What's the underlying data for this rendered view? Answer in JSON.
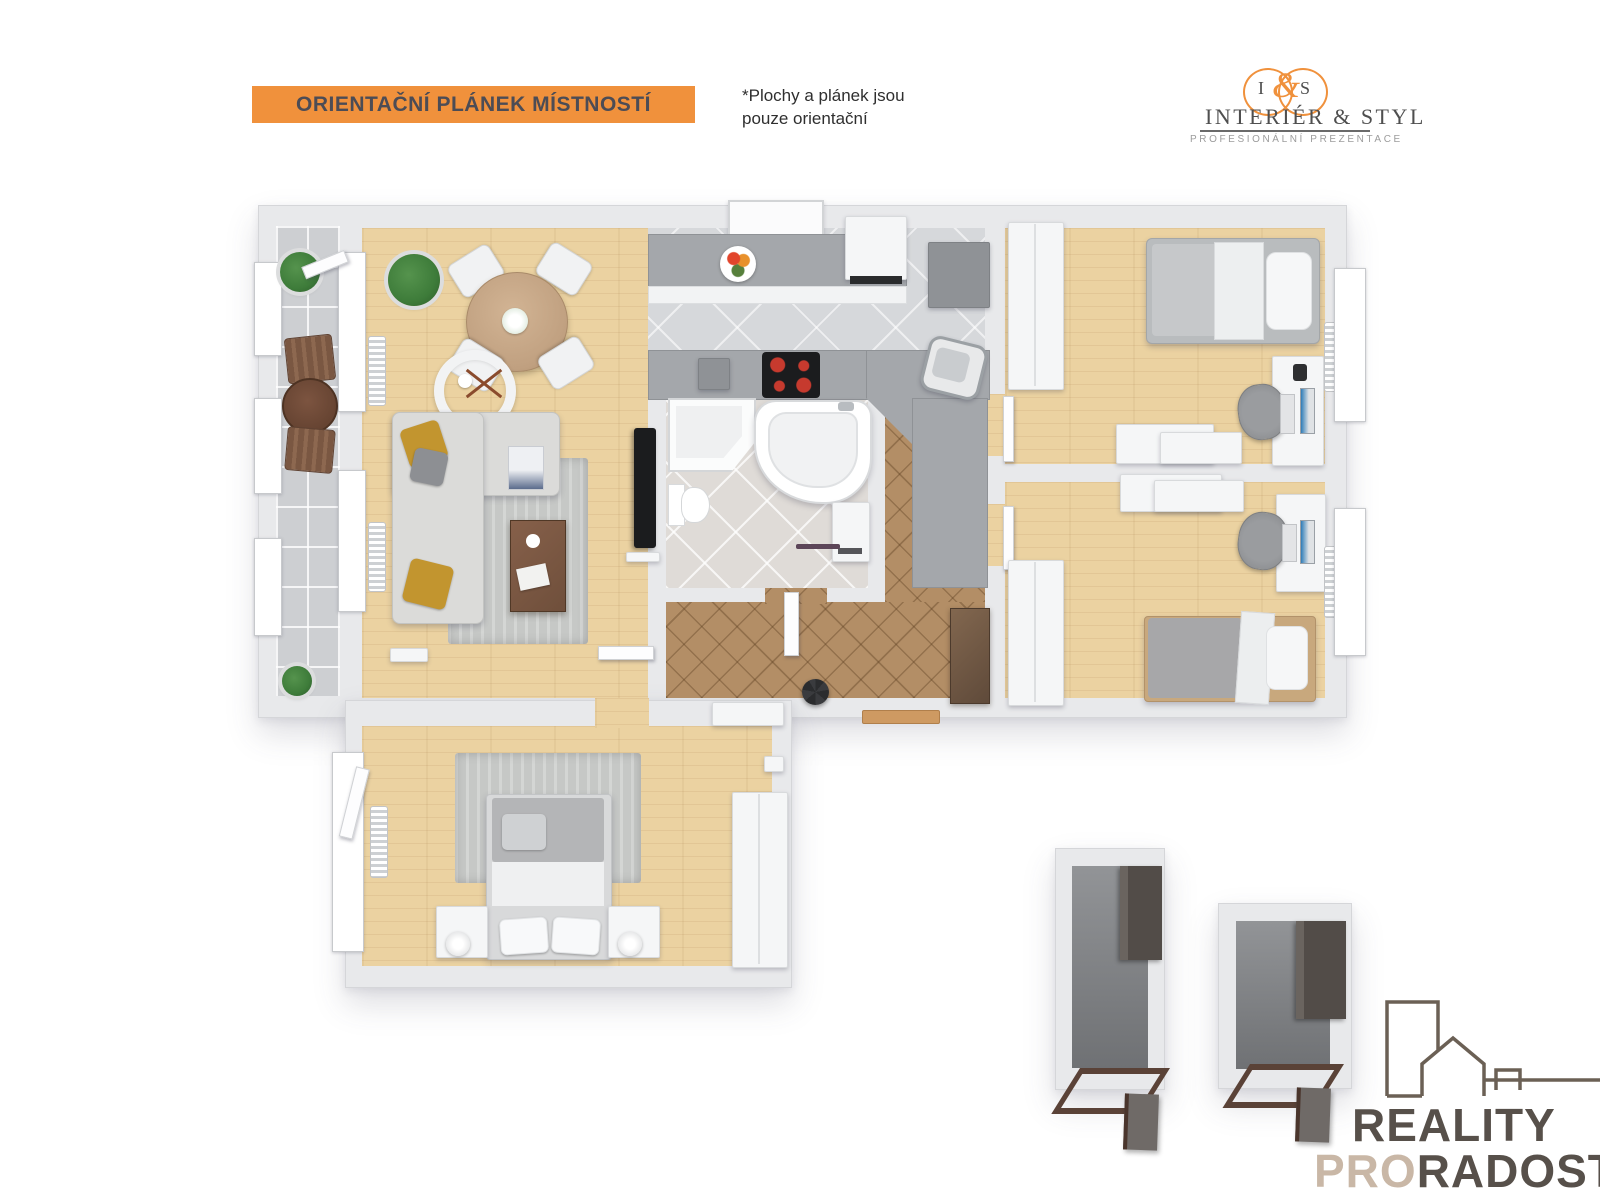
{
  "header": {
    "banner": "ORIENTAČNÍ PLÁNEK MÍSTNOSTÍ",
    "disclaimer_line1": "*Plochy  a plánek jsou",
    "disclaimer_line2": "pouze orientační"
  },
  "brand": {
    "monogram_left": "I",
    "monogram_amp": "&",
    "monogram_right": "S",
    "title": "INTERIÉR & STYL",
    "subtitle": "PROFESIONÁLNÍ PREZENTACE"
  },
  "footer_brand": {
    "line1": "REALITY",
    "line2_accent": "PRO",
    "line2_rest": "RADOST"
  },
  "palette": {
    "accent": "#F0913C",
    "banner_text": "#4C4C55",
    "ink": "#2F2F2F",
    "logo_ink": "#4F4F4F",
    "logo_sub": "#9C9C9C",
    "footer_ink": "#57504A",
    "footer_accent": "#C9B7A6",
    "wall": "#E8E9EB",
    "wall_line": "#D5D6D9",
    "wood": "#EBD2A1",
    "tile_balcony": "#CDCFD2",
    "tile_kitchen": "#D6D8DB",
    "tile_bath": "#DFDBD7",
    "tile_hall": "#B38E66",
    "counter": "#A4A7AB",
    "white_furn": "#F5F6F7",
    "rug": "#C6C8C6",
    "dark_wood": "#6F4F3B",
    "storage_cab": "#524C48",
    "door_brown": "#5A4237",
    "tv": "#1B1C1E",
    "plant": "#3E7C3A",
    "pot": "#DCDDDE",
    "pillow": "#C2952F",
    "burner": "#C63A2E"
  }
}
